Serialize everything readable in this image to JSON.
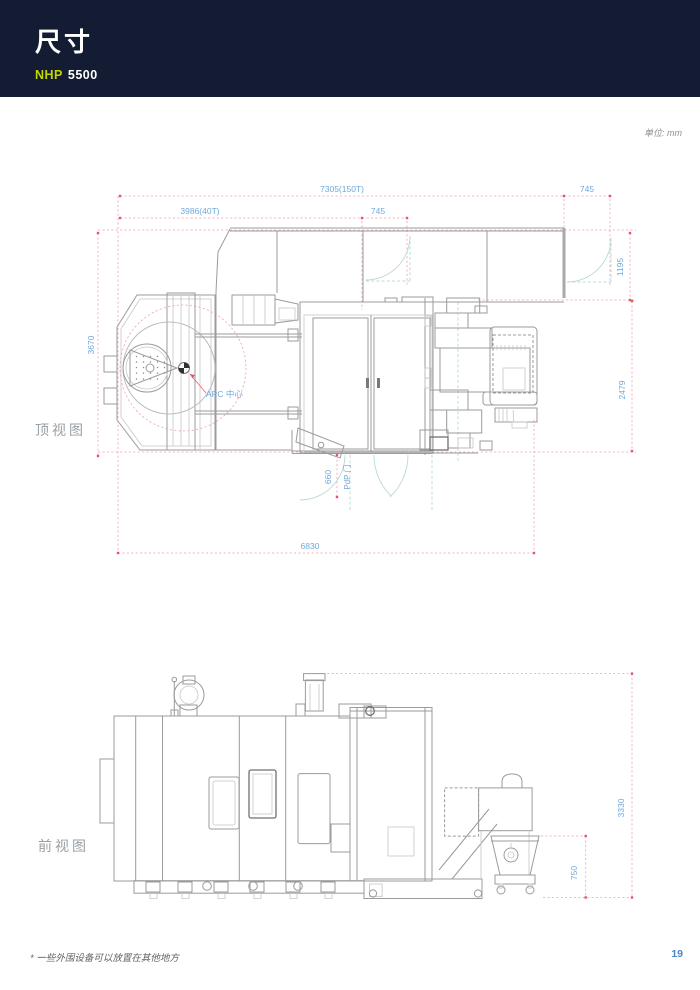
{
  "header": {
    "title": "尺寸",
    "model_brand": "NHP",
    "model_number": "5500"
  },
  "unit_note": "单位: mm",
  "views": {
    "top": {
      "label": "顶视图",
      "dimensions": {
        "overall_width": "7305(150T)",
        "right_door_width": "745",
        "width_40t": "3986(40T)",
        "mid_door_width": "745",
        "fence_depth": "1195",
        "total_depth": "3670",
        "body_depth": "2479",
        "pdp_offset": "660",
        "pdp_door_label": "PdP 门",
        "apc_center_label": "APC 中心",
        "floor_width": "6830"
      }
    },
    "front": {
      "label": "前视图",
      "dimensions": {
        "overall_height": "3330",
        "cart_height": "750"
      }
    }
  },
  "footnote": "* 一些外围设备可以放置在其他地方",
  "page_number": "19",
  "colors": {
    "header_bg": "#131c33",
    "brand_accent": "#c3d600",
    "dimension_text": "#6fa8dc",
    "dimension_line": "#efa4b2",
    "tick": "#e4556a",
    "door_arc": "#b7dcd2",
    "drawing_line": "#9b9b9b",
    "page_number": "#4a86c8"
  }
}
